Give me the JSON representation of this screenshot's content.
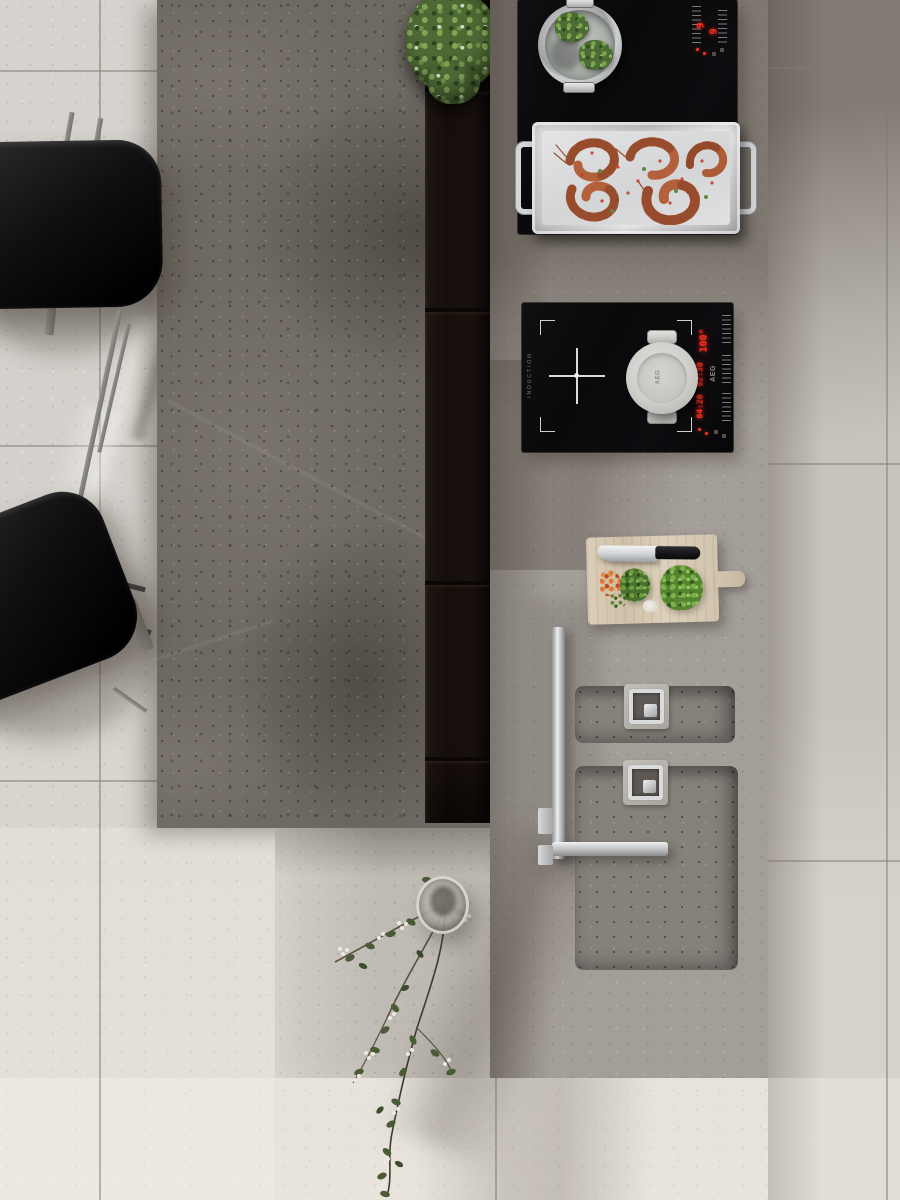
{
  "labels": {
    "pot_lid_brand": "AEG",
    "cooktop_brand": "AEG",
    "induction_label": "INDUCTION",
    "temp_display": "100°",
    "timer_display_1": "02:30",
    "timer_display_2": "04:20",
    "power_level_left": "9",
    "power_level_right": "9"
  },
  "palette": {
    "floor_tile": "#d8d5d0",
    "floor_grout": "#a9a49d",
    "island_concrete": "#6e6962",
    "island_channel": "#1b1310",
    "counter_concrete": "#a49e98",
    "cooktop_glass": "#0b0b0d",
    "led_red": "#ff3020",
    "stainless_steel": "#d3d4d6",
    "pot_enamel": "#d0cfcb",
    "cutting_board_wood": "#d7cab4",
    "herb_green": "#55842f",
    "shrimp_orange": "#b2613c",
    "chair_black": "#151515",
    "leaf_green": "#4b5a37",
    "flower_white": "#eceadf"
  }
}
